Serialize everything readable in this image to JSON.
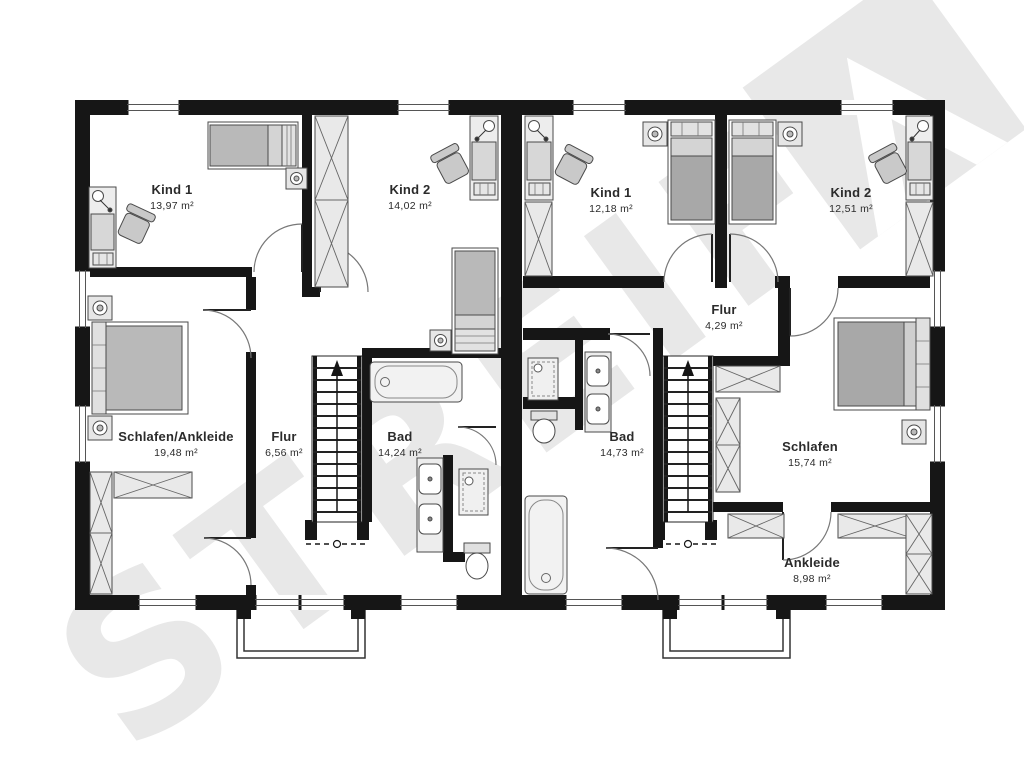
{
  "watermark": {
    "text": "STREIF",
    "logo": "streif-house-arrow-logo",
    "color": "#e8e8e8"
  },
  "units": [
    {
      "id": "left-unit",
      "rooms": [
        {
          "name": "Kind 1",
          "area": "13,97 m²"
        },
        {
          "name": "Kind 2",
          "area": "14,02 m²"
        },
        {
          "name": "Schlafen/Ankleide",
          "area": "19,48 m²"
        },
        {
          "name": "Flur",
          "area": "6,56 m²"
        },
        {
          "name": "Bad",
          "area": "14,24 m²"
        }
      ]
    },
    {
      "id": "right-unit",
      "rooms": [
        {
          "name": "Kind 1",
          "area": "12,18 m²"
        },
        {
          "name": "Kind 2",
          "area": "12,51 m²"
        },
        {
          "name": "Flur",
          "area": "4,29 m²"
        },
        {
          "name": "Bad",
          "area": "14,73 m²"
        },
        {
          "name": "Schlafen",
          "area": "15,74 m²"
        },
        {
          "name": "Ankleide",
          "area": "8,98 m²"
        }
      ]
    }
  ],
  "colors": {
    "wall": "#161616",
    "furniture": "#b9b9b9",
    "furniture_light": "#dcdcdc",
    "panel": "#ededed",
    "watermark": "#e8e8e8",
    "label": "#2b2b2b"
  }
}
